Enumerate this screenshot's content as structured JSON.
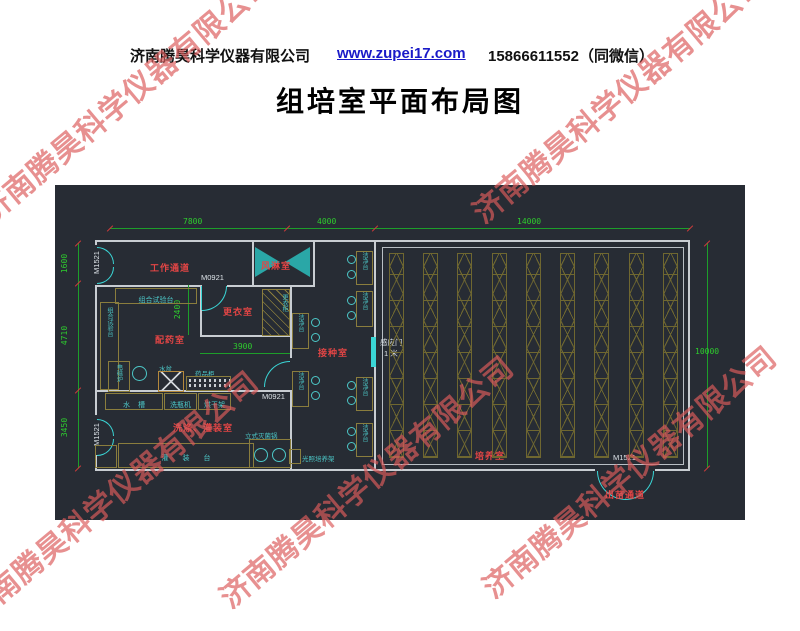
{
  "header": {
    "company": "济南腾昊科学仪器有限公司",
    "website": "www.zupei17.com",
    "phone": "15866611552（同微信）"
  },
  "title": "组培室平面布局图",
  "watermark": {
    "text": "济南腾昊科学仪器有限公司"
  },
  "colors": {
    "canvas_bg": "#272c34",
    "wall": "#c8cdd2",
    "dimension_green": "#2ecc2e",
    "room_label_red": "#e34545",
    "door_cyan": "#3ad6d6",
    "furniture_olive": "#8a7d3d",
    "watermark_red": "#db5c5c"
  },
  "plan": {
    "dims": {
      "d7800": "7800",
      "d4000": "4000",
      "d14000": "14000",
      "d1600": "1600",
      "d4710": "4710",
      "d3450": "3450",
      "d10000": "10000",
      "d2400": "2400",
      "d3900": "3900"
    },
    "rooms": {
      "work_corridor": "工作通道",
      "air_shower": "风淋室",
      "dressing": "更衣室",
      "media_prep": "配药室",
      "inoculation": "接种室",
      "washing_filling": "洗涤、灌装室",
      "culture": "培养室",
      "seedling_exit": "出苗通道"
    },
    "doors": {
      "m1521": "M1521",
      "m0921": "M0921",
      "sensor": "感应门",
      "sensor_width": "1 米"
    },
    "furniture": {
      "combo_bench": "组合试验台",
      "wardrobe": "更衣柜",
      "clean_bench": "洁净台",
      "water_basin": "水盆",
      "medicine_cabinet": "药品柜",
      "sink": "水槽",
      "bottle_washer": "洗瓶机",
      "drying_rack": "烘干架",
      "induction_cooker": "电磁炉",
      "filling_bench": "灌装台",
      "autoclave": "立式灭菌锅",
      "light_shelf": "光照培养架"
    }
  }
}
